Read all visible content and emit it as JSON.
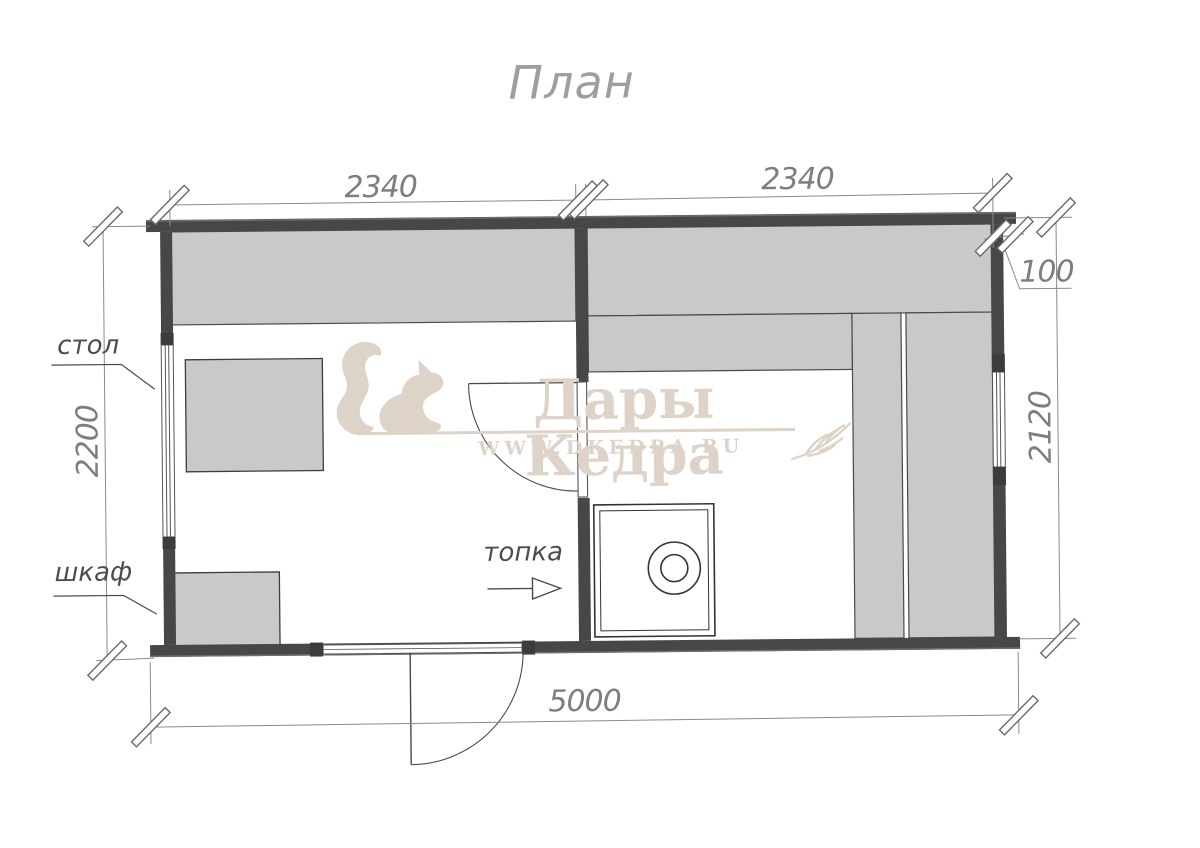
{
  "title": "План",
  "watermark": {
    "brand": "Дары Кедра",
    "url": "WWW.DKEDRA.RU",
    "color": "#ded3c8"
  },
  "labels": {
    "table": "стол",
    "cabinet": "шкаф",
    "firebox": "топка"
  },
  "dimensions": {
    "room1_width_mm": "2340",
    "room2_width_mm": "2340",
    "wall_offset_mm": "100",
    "right_depth_mm": "2120",
    "left_depth_mm": "2200",
    "total_width_mm": "5000"
  },
  "colors": {
    "wall": "#474747",
    "bench_fill": "#c9c9c9",
    "dimension_line": "#8a8a8a",
    "watermark": "#ded3c8",
    "background": "#ffffff"
  }
}
